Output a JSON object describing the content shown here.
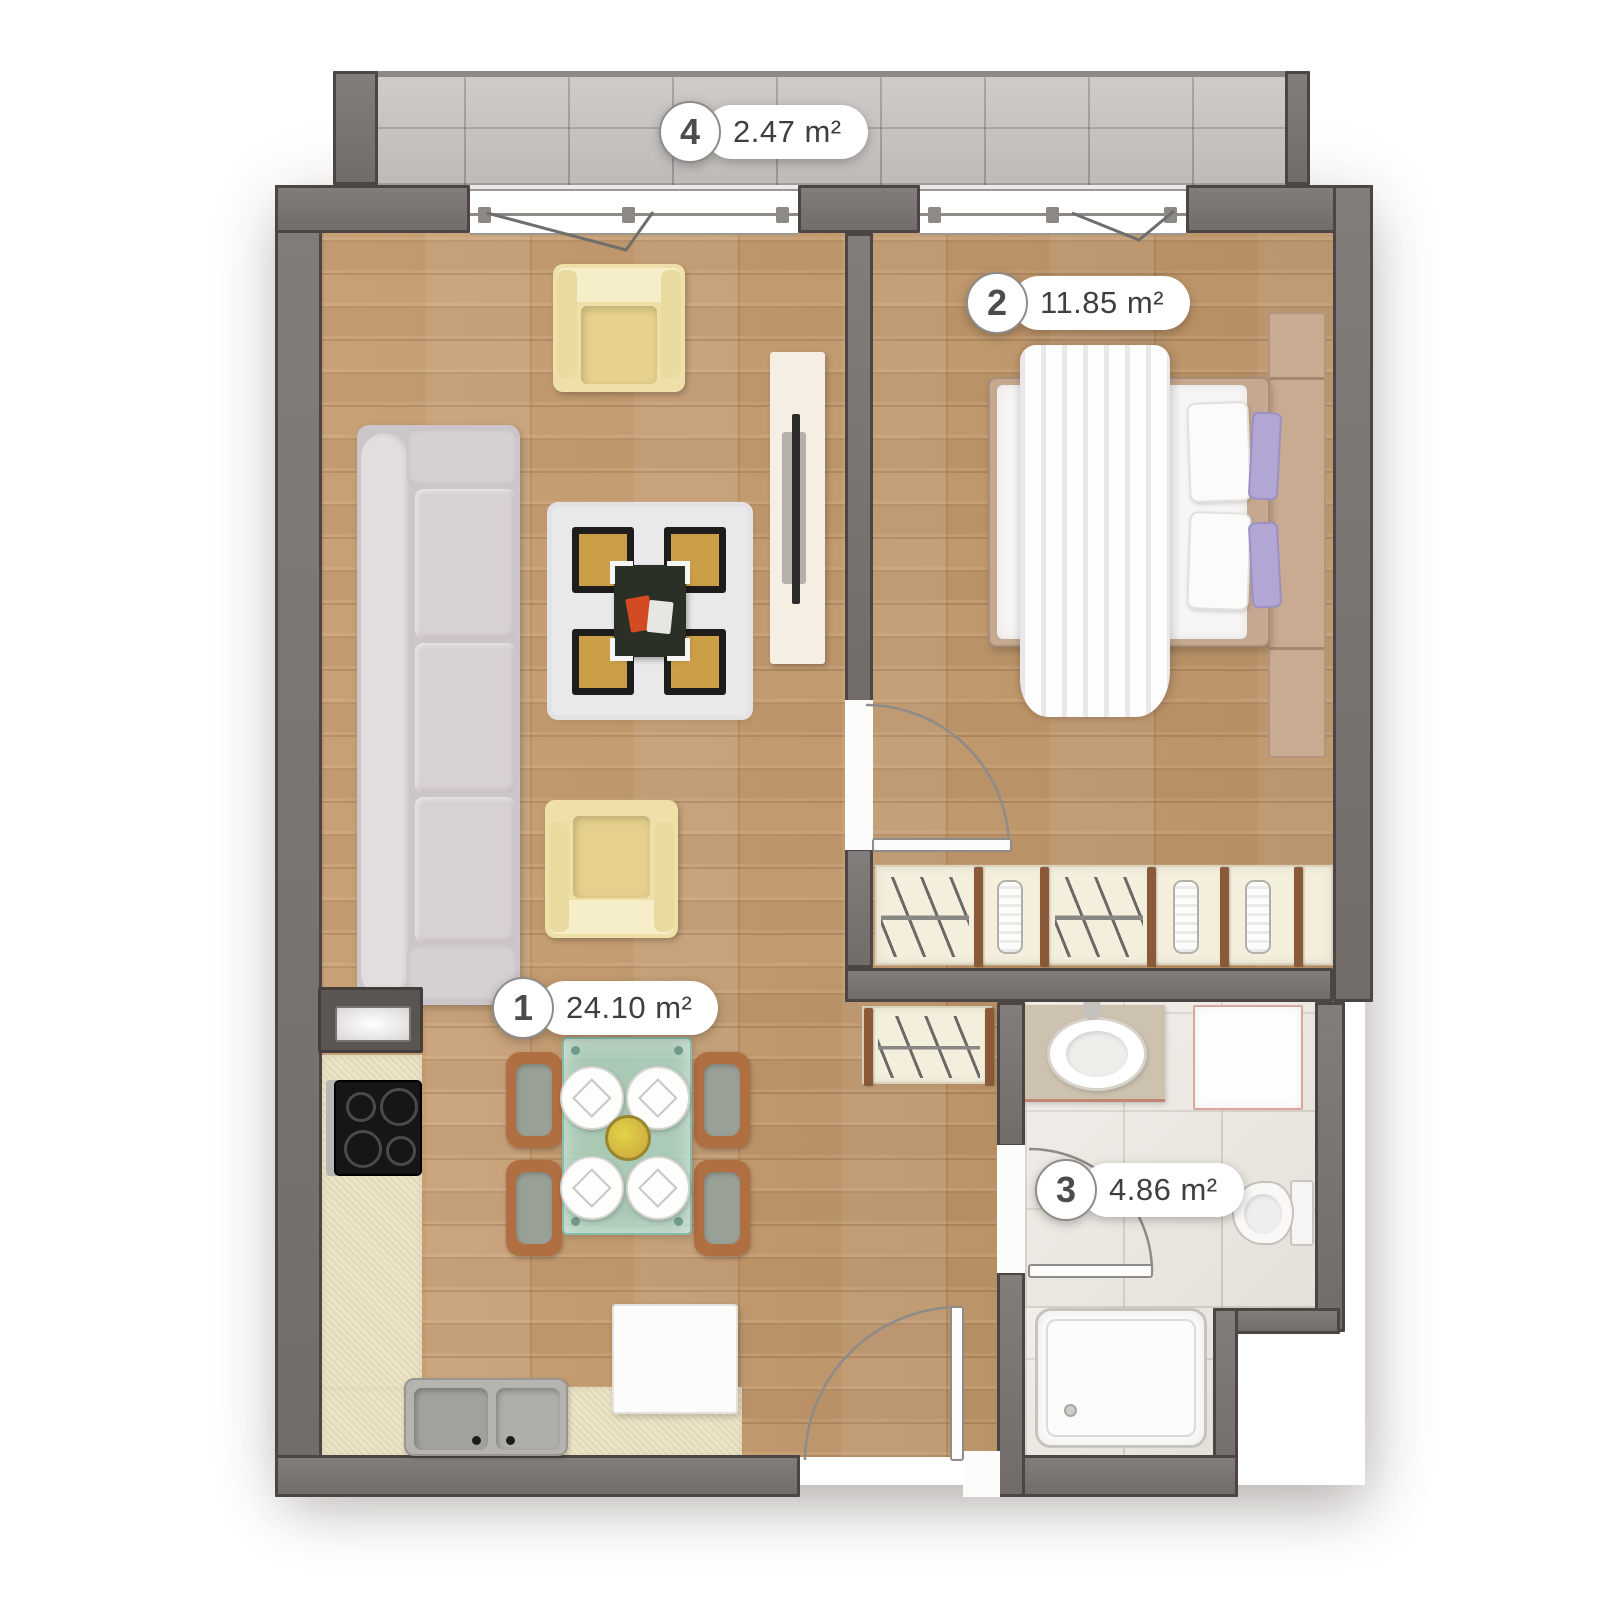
{
  "plan": {
    "rooms": [
      {
        "number": "1",
        "area": "24.10 m²",
        "type": "living-room-kitchen"
      },
      {
        "number": "2",
        "area": "11.85 m²",
        "type": "bedroom"
      },
      {
        "number": "3",
        "area": "4.86 m²",
        "type": "bathroom"
      },
      {
        "number": "4",
        "area": "2.47 m²",
        "type": "balcony"
      }
    ],
    "colors": {
      "wall": "#78726f",
      "wall_outline": "#4b4643",
      "wood_floor": "#c59b6e",
      "balcony_tile": "#c9c6c3",
      "bathroom_tile": "#ebe7e0",
      "rug_gold": "#cb9f47",
      "sofa": "#ccc5c9",
      "armchair": "#efe0aa",
      "table_glass": "#a5d6c8",
      "pillow_accent": "#b2a6d4",
      "kitchen_counter": "#ece4c8"
    }
  }
}
